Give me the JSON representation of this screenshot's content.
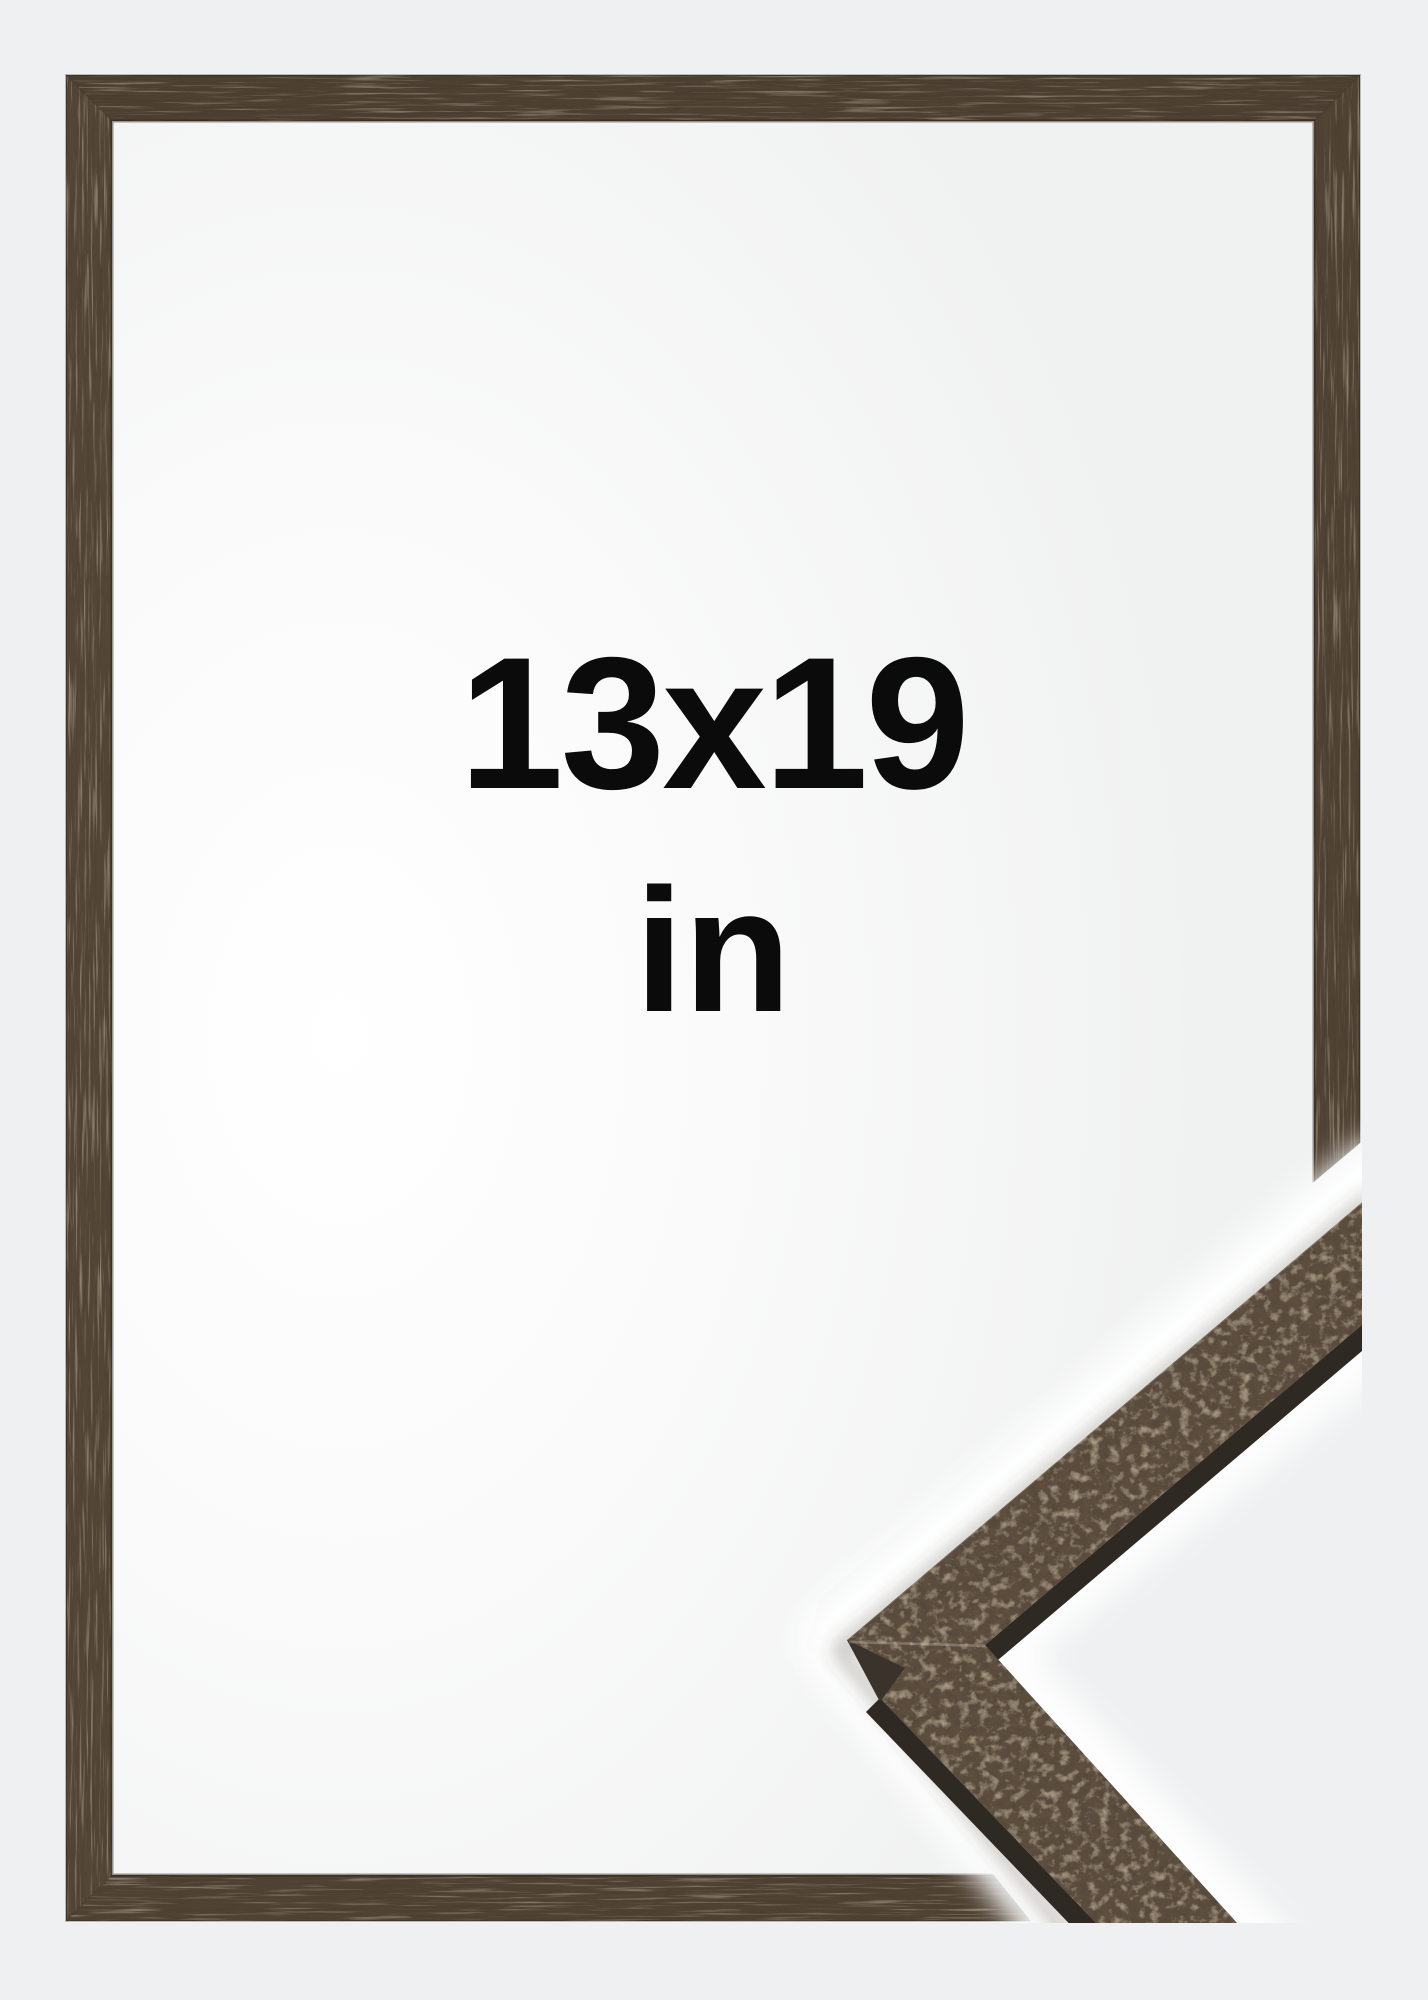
{
  "label": {
    "size": "13x19",
    "unit": "in"
  },
  "colors": {
    "background": "#eff0f1",
    "interior": "#ffffff",
    "frame_wood": "#554739",
    "detail_wood": "#5e4f3f",
    "detail_wood_side": "#2f2923",
    "text": "#0b0b0b"
  }
}
